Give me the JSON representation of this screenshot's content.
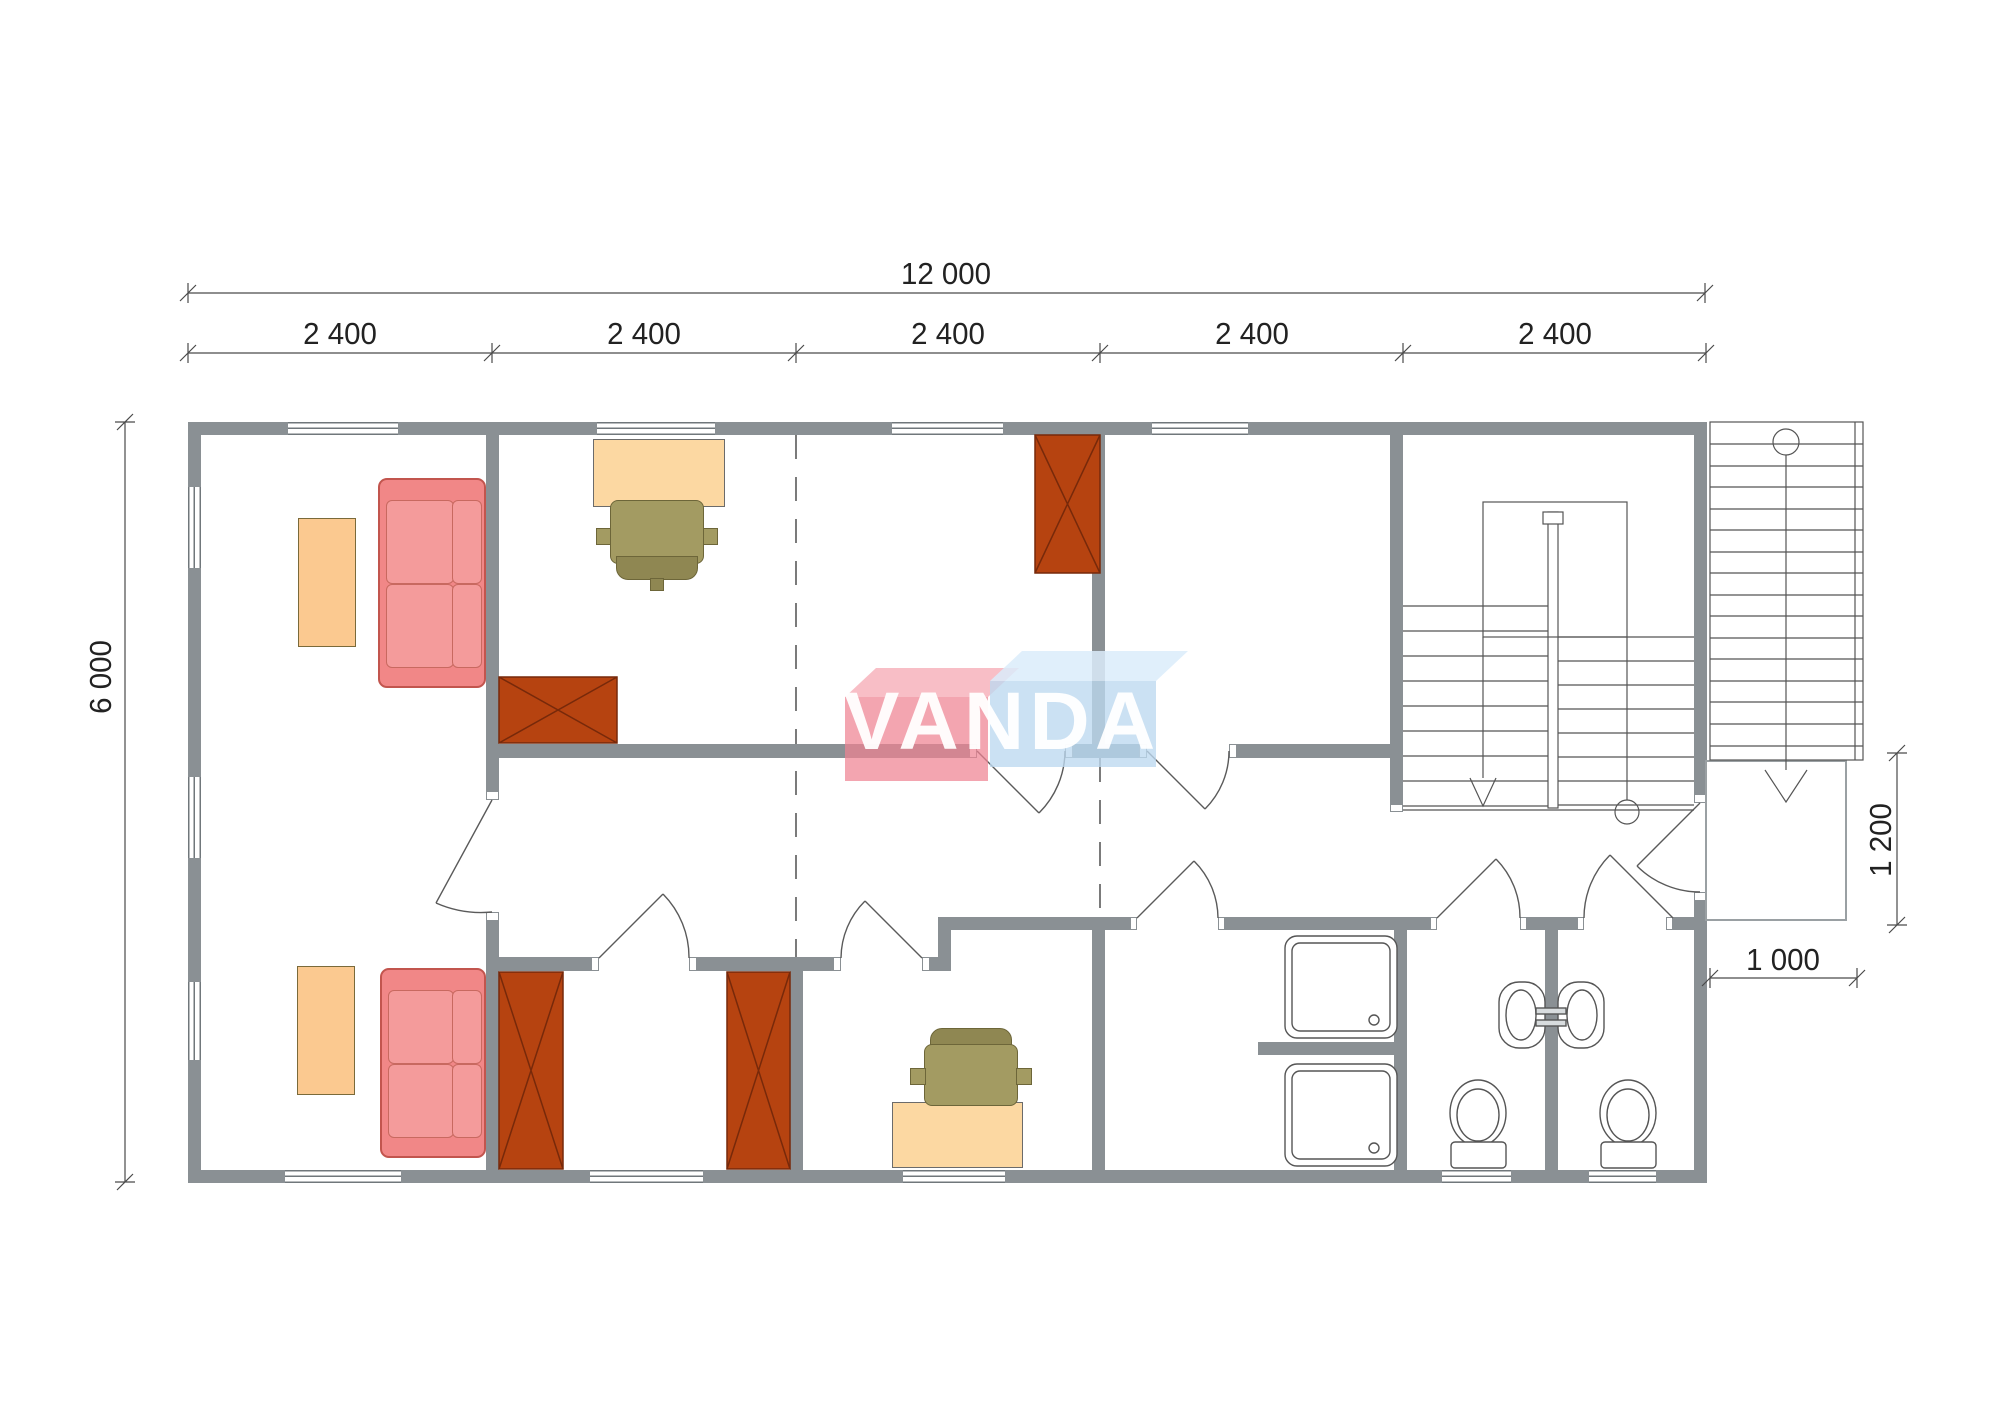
{
  "watermark": {
    "text": "VANDA",
    "red_box_color": "#ee8291",
    "blue_box_color": "#bcd8f0"
  },
  "dimensions": {
    "overall_width": {
      "label": "12 000"
    },
    "overall_depth": {
      "label": "6 000"
    },
    "modules": [
      {
        "label": "2 400"
      },
      {
        "label": "2 400"
      },
      {
        "label": "2 400"
      },
      {
        "label": "2 400"
      },
      {
        "label": "2 400"
      }
    ],
    "porch_depth": {
      "label": "1 200"
    },
    "porch_width": {
      "label": "1 000"
    }
  },
  "colors": {
    "wall": "#8a9094",
    "wardrobe": "#b64310",
    "sofa": "#f18787",
    "table": "#fbc990",
    "desk": "#fcd8a2",
    "chair": "#a39b62",
    "line": "#4a4a4a"
  },
  "furniture_icons": {
    "sofa": "two-seat sofa plan symbol",
    "coffee-table": "rectangle table plan symbol",
    "desk": "desk with office chair plan symbol",
    "wardrobe": "rectangle with X plan symbol",
    "shower-tray": "square tray with drain plan symbol",
    "sink": "basin plan symbol",
    "toilet": "toilet plan symbol",
    "stairs": "treads with direction line, circle start and arrow end"
  }
}
